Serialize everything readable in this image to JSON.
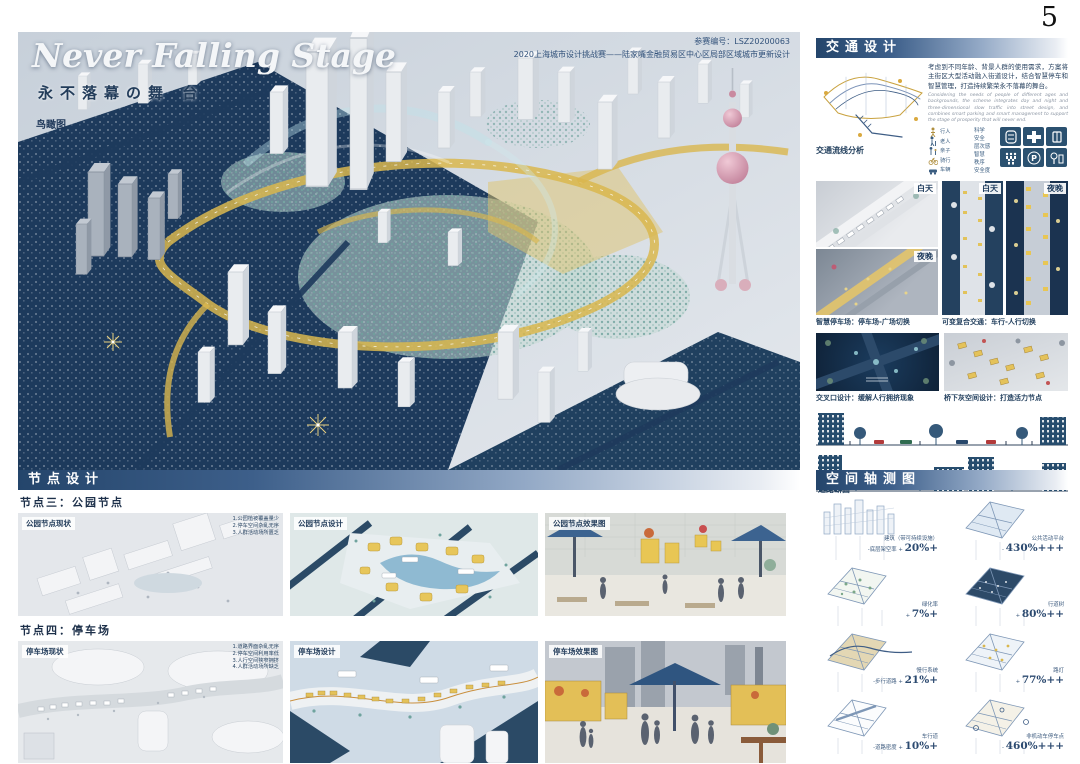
{
  "page": {
    "number": "5"
  },
  "hero": {
    "title": "Never Falling Stage",
    "subtitle": "永不落幕の舞 台",
    "view_label": "鸟瞰图",
    "entry_no": "参赛编号：LSZ20200063",
    "competition": "2020上海城市设计挑战赛——陆家嘴金融贸易区中心区局部区域城市更新设计"
  },
  "traffic": {
    "header": "交通设计",
    "flow_caption": "交通流线分析",
    "intro_cn": "考虑到不同年龄、背景人群的使用需求，方案将主街区大型活动融入街道设计，结合智慧停车和智慧管理，打造持续繁荣永不落幕的舞台。",
    "intro_en": "Considering the needs of people of different ages and backgrounds, the scheme integrates day and night and three-dimensional slow traffic into street design, and combines smart parking and smart management to support the stage of prosperity that will never end.",
    "legend": {
      "users": [
        "行人",
        "老人",
        "亲子",
        "骑行",
        "车辆"
      ],
      "qualities": [
        "科学",
        "安全",
        "层次感",
        "智慧",
        "秩序",
        "安全度"
      ]
    },
    "tags": {
      "day": "白天",
      "night": "夜晚"
    },
    "captions": {
      "smart_parking": "智慧停车场：停车场-广场切换",
      "flex_traffic": "可变复合交通：车行-人行切换",
      "crossing": "交叉口设计：缓解人行拥挤现象",
      "underbridge": "桥下灰空间设计：打造活力节点",
      "section": "道路断面"
    }
  },
  "nodes": {
    "header": "节点设计",
    "rows": [
      {
        "title": "节点三：公园节点",
        "panels": [
          {
            "label": "公园节点现状",
            "note": "1.公园植被覆盖量少\n2.停车空间杂乱无序\n3.人群活动场所匮乏"
          },
          {
            "label": "公园节点设计",
            "note": ""
          },
          {
            "label": "公园节点效果图",
            "note": ""
          }
        ]
      },
      {
        "title": "节点四：停车场",
        "panels": [
          {
            "label": "停车场现状",
            "note": "1.道路界面杂乱无序\n2.停车空间利用率低\n3.人行空间狭窄拥挤\n4.人群活动场所缺乏"
          },
          {
            "label": "停车场设计",
            "note": ""
          },
          {
            "label": "停车场效果图",
            "note": ""
          }
        ]
      }
    ]
  },
  "axon": {
    "header": "空间轴测图",
    "labels": [
      {
        "name": "建筑（带可持续设施）",
        "metric": "-底层架空率 +",
        "value": "20%+"
      },
      {
        "name": "公共活动平台",
        "metric": "-",
        "value": "430%+++"
      },
      {
        "name": "绿化率",
        "metric": "+",
        "value": "7%+"
      },
      {
        "name": "行道树",
        "metric": "+",
        "value": "80%++"
      },
      {
        "name": "慢行系统",
        "metric": "-步行道路 +",
        "value": "21%+"
      },
      {
        "name": "路灯",
        "metric": "+",
        "value": "77%++"
      },
      {
        "name": "车行道",
        "metric": "-道路密度 +",
        "value": "10%+"
      },
      {
        "name": "非机动车停车点",
        "metric": "-",
        "value": "460%+++"
      }
    ]
  }
}
